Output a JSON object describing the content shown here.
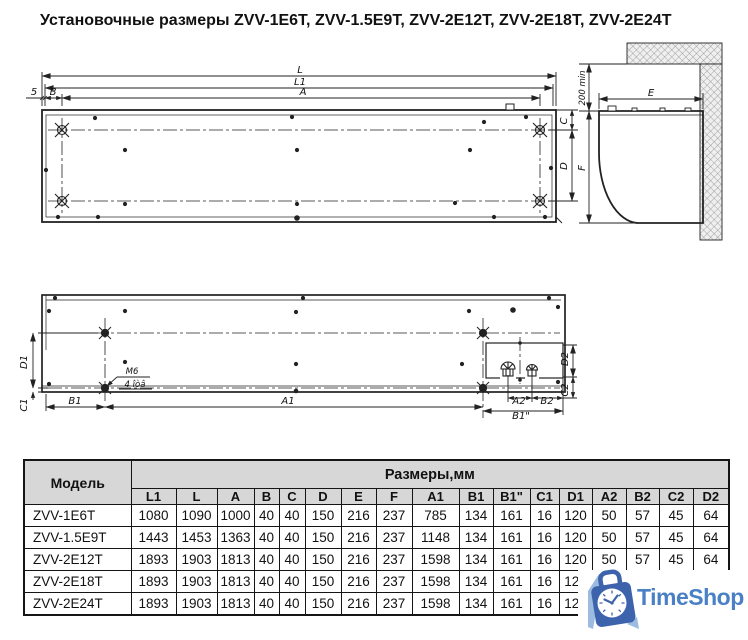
{
  "title": "Установочные размеры ZVV-1E6T, ZVV-1.5E9T, ZVV-2E12T, ZVV-2E18T, ZVV-2E24T",
  "drawing": {
    "labels": {
      "L": "L",
      "L1": "L1",
      "A": "A",
      "B": "B",
      "five": "5",
      "C": "C",
      "D": "D",
      "min200": "200 min",
      "E": "E",
      "F": "F",
      "D1": "D1",
      "C1": "C1",
      "B1": "B1",
      "A1": "A1",
      "M6": "М6",
      "holes": "4 îòâ",
      "A2": "A2",
      "B2": "B2",
      "B1s": "В1\"",
      "D2": "D2",
      "C2": "C2"
    }
  },
  "table": {
    "model_header": "Модель",
    "group_header": "Размеры,мм",
    "columns": [
      "L1",
      "L",
      "A",
      "B",
      "C",
      "D",
      "E",
      "F",
      "A1",
      "B1",
      "B1\"",
      "C1",
      "D1",
      "A2",
      "B2",
      "C2",
      "D2"
    ],
    "rows": [
      {
        "model": "ZVV-1E6T",
        "values": [
          "1080",
          "1090",
          "1000",
          "40",
          "40",
          "150",
          "216",
          "237",
          "785",
          "134",
          "161",
          "16",
          "120",
          "50",
          "57",
          "45",
          "64"
        ]
      },
      {
        "model": "ZVV-1.5E9T",
        "values": [
          "1443",
          "1453",
          "1363",
          "40",
          "40",
          "150",
          "216",
          "237",
          "1148",
          "134",
          "161",
          "16",
          "120",
          "50",
          "57",
          "45",
          "64"
        ]
      },
      {
        "model": "ZVV-2E12T",
        "values": [
          "1893",
          "1903",
          "1813",
          "40",
          "40",
          "150",
          "216",
          "237",
          "1598",
          "134",
          "161",
          "16",
          "120",
          "50",
          "57",
          "45",
          "64"
        ]
      },
      {
        "model": "ZVV-2E18T",
        "values": [
          "1893",
          "1903",
          "1813",
          "40",
          "40",
          "150",
          "216",
          "237",
          "1598",
          "134",
          "161",
          "16",
          "120",
          "",
          "",
          "",
          ""
        ]
      },
      {
        "model": "ZVV-2E24T",
        "values": [
          "1893",
          "1903",
          "1813",
          "40",
          "40",
          "150",
          "216",
          "237",
          "1598",
          "134",
          "161",
          "16",
          "120",
          "",
          "",
          "",
          ""
        ]
      }
    ]
  },
  "watermark": {
    "brand": "TimeShop",
    "text_color": "#4a80c5",
    "bag_color": "#3d63ac",
    "accent_color": "#9bbce0"
  }
}
